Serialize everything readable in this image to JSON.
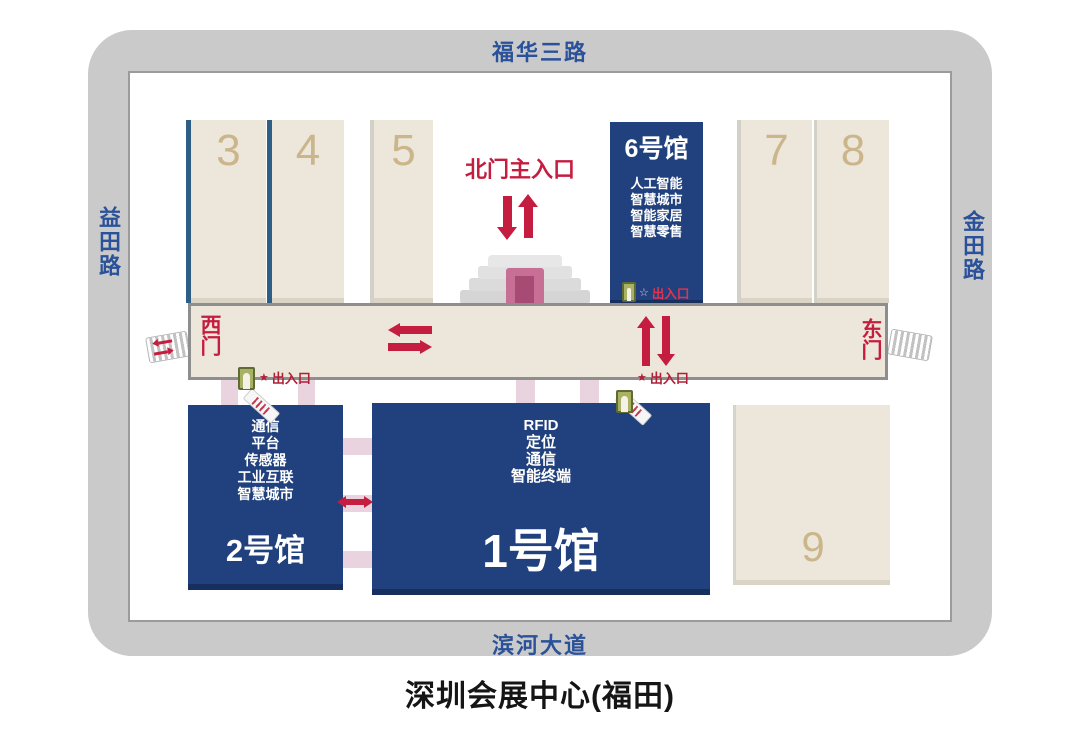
{
  "title": "深圳会展中心(福田)",
  "roads": {
    "top": "福华三路",
    "left": "益田路",
    "right": "金田路",
    "bottom": "滨河大道"
  },
  "gates": {
    "north_main": "北门主入口",
    "west": "西门",
    "east": "东门"
  },
  "markers": {
    "entrance_exit": "出入口",
    "star": "★",
    "star_outline": "☆"
  },
  "halls": {
    "h1": {
      "name": "1号馆",
      "tags": [
        "RFID",
        "定位",
        "通信",
        "智能终端"
      ]
    },
    "h2": {
      "name": "2号馆",
      "tags": [
        "通信",
        "平台",
        "传感器",
        "工业互联",
        "智慧城市"
      ]
    },
    "h3": {
      "number": "3"
    },
    "h4": {
      "number": "4"
    },
    "h5": {
      "number": "5"
    },
    "h6": {
      "name": "6号馆",
      "tags": [
        "人工智能",
        "智慧城市",
        "智能家居",
        "智慧零售"
      ]
    },
    "h7": {
      "number": "7"
    },
    "h8": {
      "number": "8"
    },
    "h9": {
      "number": "9"
    }
  },
  "colors": {
    "road_gray": "#cacaca",
    "road_text_blue": "#2a5199",
    "hall_blue": "#21417e",
    "hall_beige": "#ece7da",
    "hall_number_tan": "#cbb68c",
    "accent_red": "#c41d3f",
    "entrance_text_red": "#b01f35",
    "connector_pink": "#e9d3de",
    "door_rose": "#c86f95",
    "door_icon_green": "#a9b264"
  }
}
